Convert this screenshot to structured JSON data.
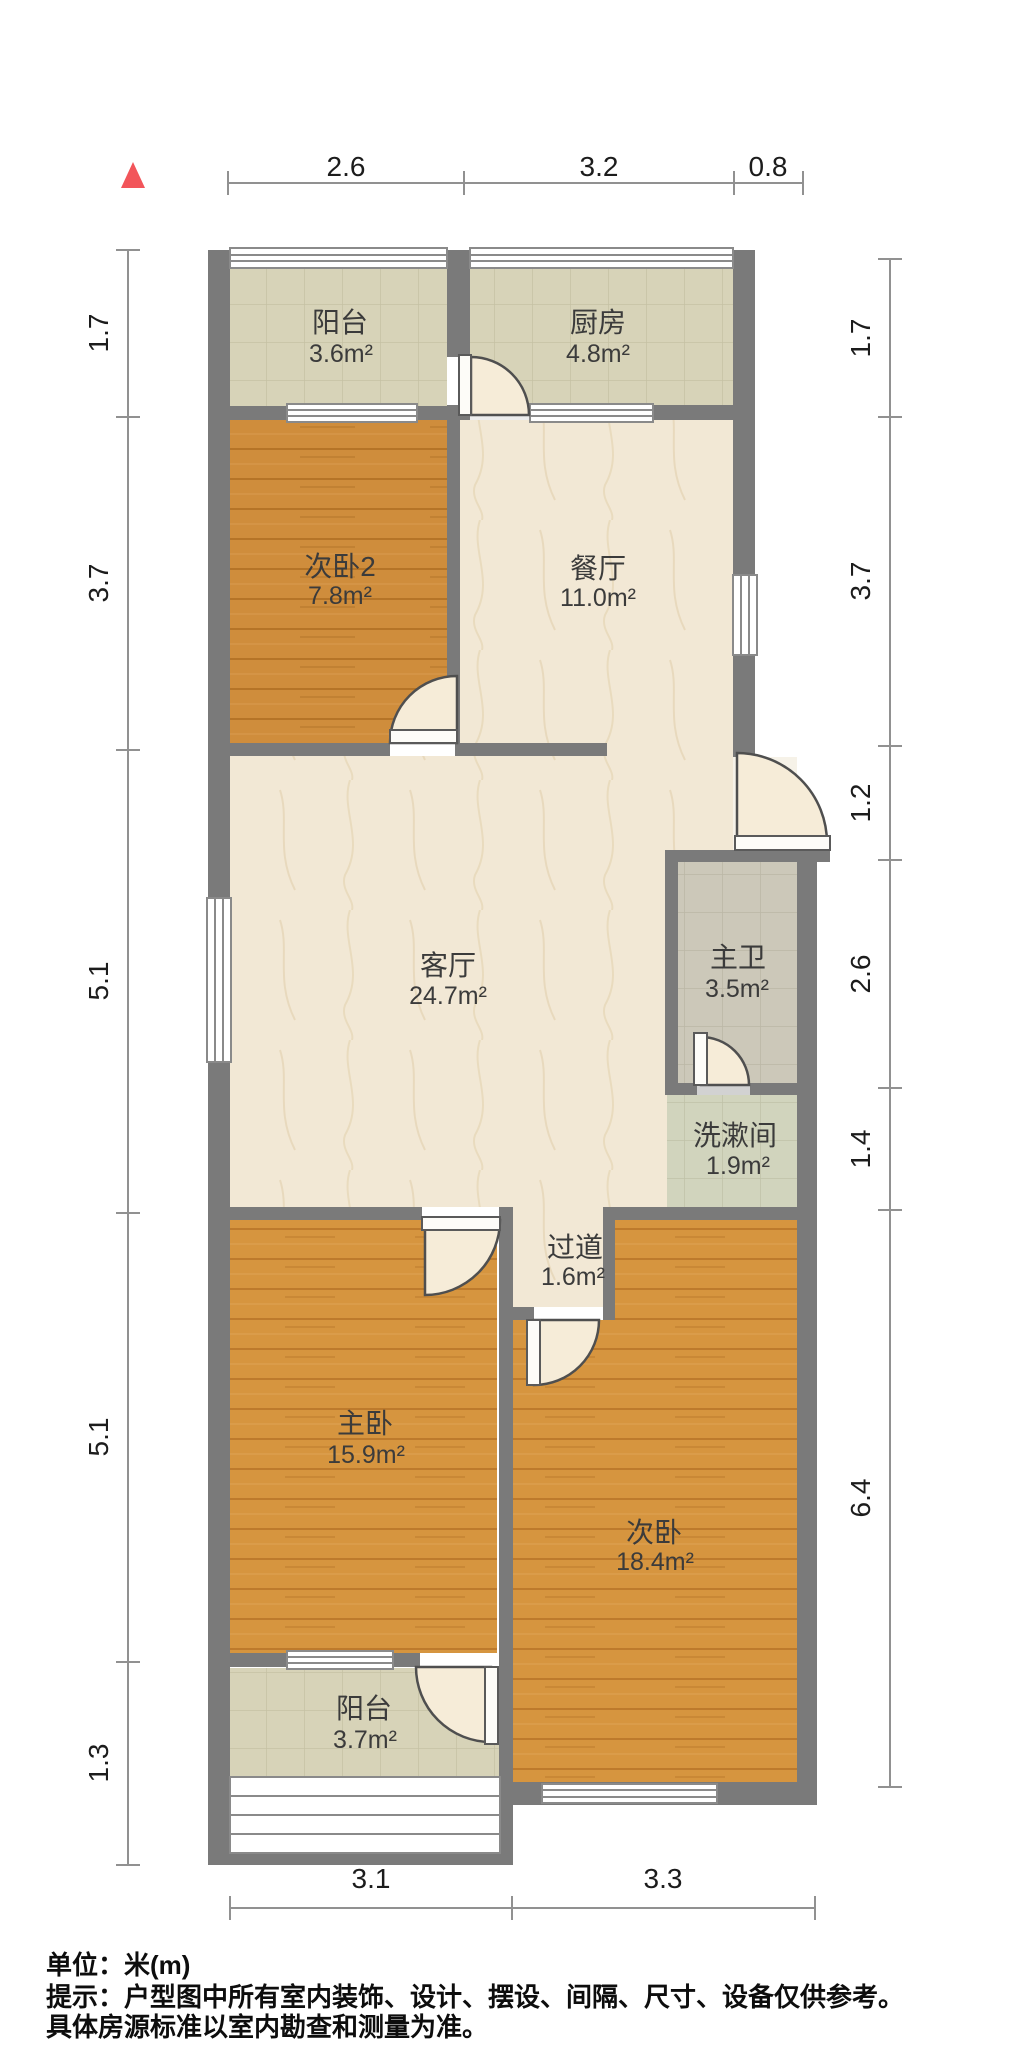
{
  "rooms": {
    "balcony_top": {
      "name": "阳台",
      "area": "3.6m²"
    },
    "kitchen": {
      "name": "厨房",
      "area": "4.8m²"
    },
    "bedroom2": {
      "name": "次卧2",
      "area": "7.8m²"
    },
    "dining": {
      "name": "餐厅",
      "area": "11.0m²"
    },
    "living": {
      "name": "客厅",
      "area": "24.7m²"
    },
    "master_bath": {
      "name": "主卫",
      "area": "3.5m²"
    },
    "washroom": {
      "name": "洗漱间",
      "area": "1.9m²"
    },
    "hallway": {
      "name": "过道",
      "area": "1.6m²"
    },
    "master_bedroom": {
      "name": "主卧",
      "area": "15.9m²"
    },
    "bedroom": {
      "name": "次卧",
      "area": "18.4m²"
    },
    "balcony_bottom": {
      "name": "阳台",
      "area": "3.7m²"
    }
  },
  "dimensions": {
    "top": [
      "2.6",
      "3.2",
      "0.8"
    ],
    "left": [
      "1.7",
      "3.7",
      "5.1",
      "5.1",
      "1.3"
    ],
    "right": [
      "1.7",
      "3.7",
      "1.2",
      "2.6",
      "1.4",
      "6.4"
    ],
    "bottom": [
      "3.1",
      "3.3"
    ]
  },
  "footer": {
    "unit": "单位：米(m)",
    "tip1": "提示：户型图中所有室内装饰、设计、摆设、间隔、尺寸、设备仅供参考。",
    "tip2": "具体房源标准以室内勘查和测量为准。"
  },
  "colors": {
    "wall": "#7a7a7a",
    "wood_floor": "#d6953f",
    "tile_floor": "#d7d3b8",
    "bath_tile": "#ccc8b9",
    "wash_tile": "#d1d4bd",
    "marble_floor": "#f2e8d5",
    "north_arrow": "#f2555a",
    "dimension_line": "#919191"
  }
}
